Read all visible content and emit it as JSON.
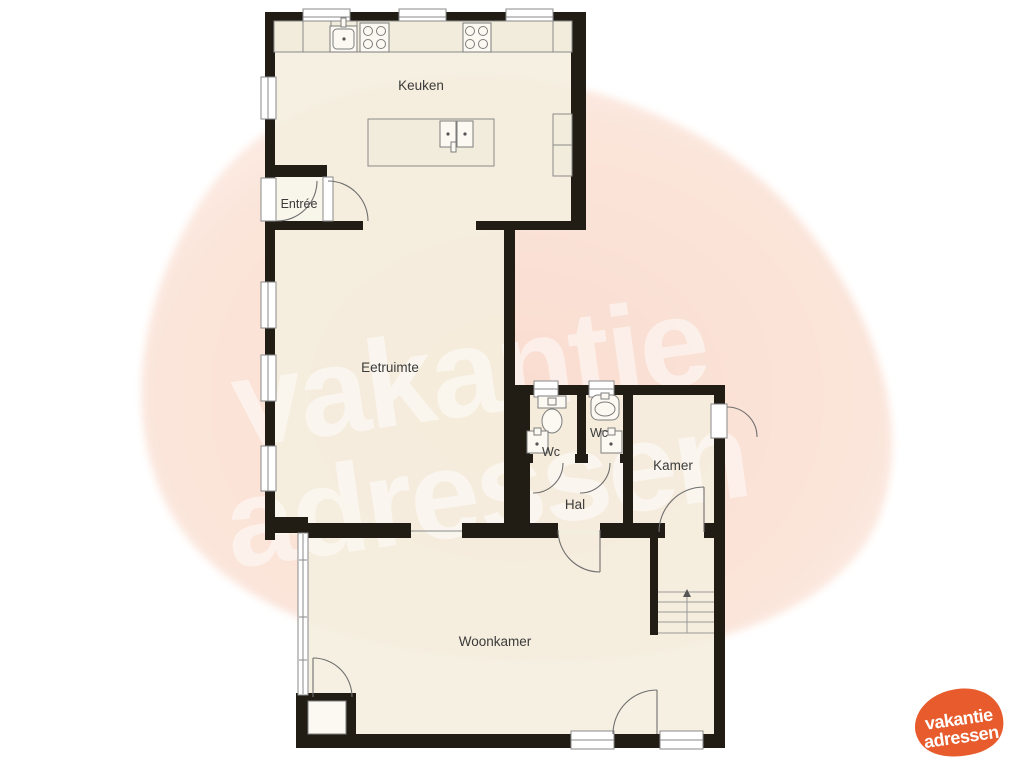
{
  "floorplan": {
    "rooms": {
      "keuken": {
        "label": "Keuken"
      },
      "entree": {
        "label": "Entrée"
      },
      "eetruimte": {
        "label": "Eetruimte"
      },
      "wc_left": {
        "label": "Wc"
      },
      "wc_right": {
        "label": "Wc"
      },
      "hal": {
        "label": "Hal"
      },
      "kamer": {
        "label": "Kamer"
      },
      "woonkamer": {
        "label": "Woonkamer"
      }
    },
    "icons": {
      "toilet": "toilet-icon",
      "sink": "sink-icon",
      "basin": "washbasin-icon",
      "stove": "stove-icon",
      "kitchen_island": "kitchen-island",
      "counter": "kitchen-counter",
      "stairs": "stairs-up-icon",
      "door": "door-swing",
      "window": "window"
    }
  },
  "watermark": {
    "line1": "vakantie",
    "line2": "adressen"
  },
  "logo": {
    "line1": "vakantie",
    "line2": "adressen"
  },
  "colors": {
    "wall": "#211d15",
    "floor": "#f3eede",
    "label": "#3b3b3b",
    "blob_center": "#f9ddd0",
    "blob_edge": "#fdeee7",
    "logo_orange": "#e75b2c"
  }
}
